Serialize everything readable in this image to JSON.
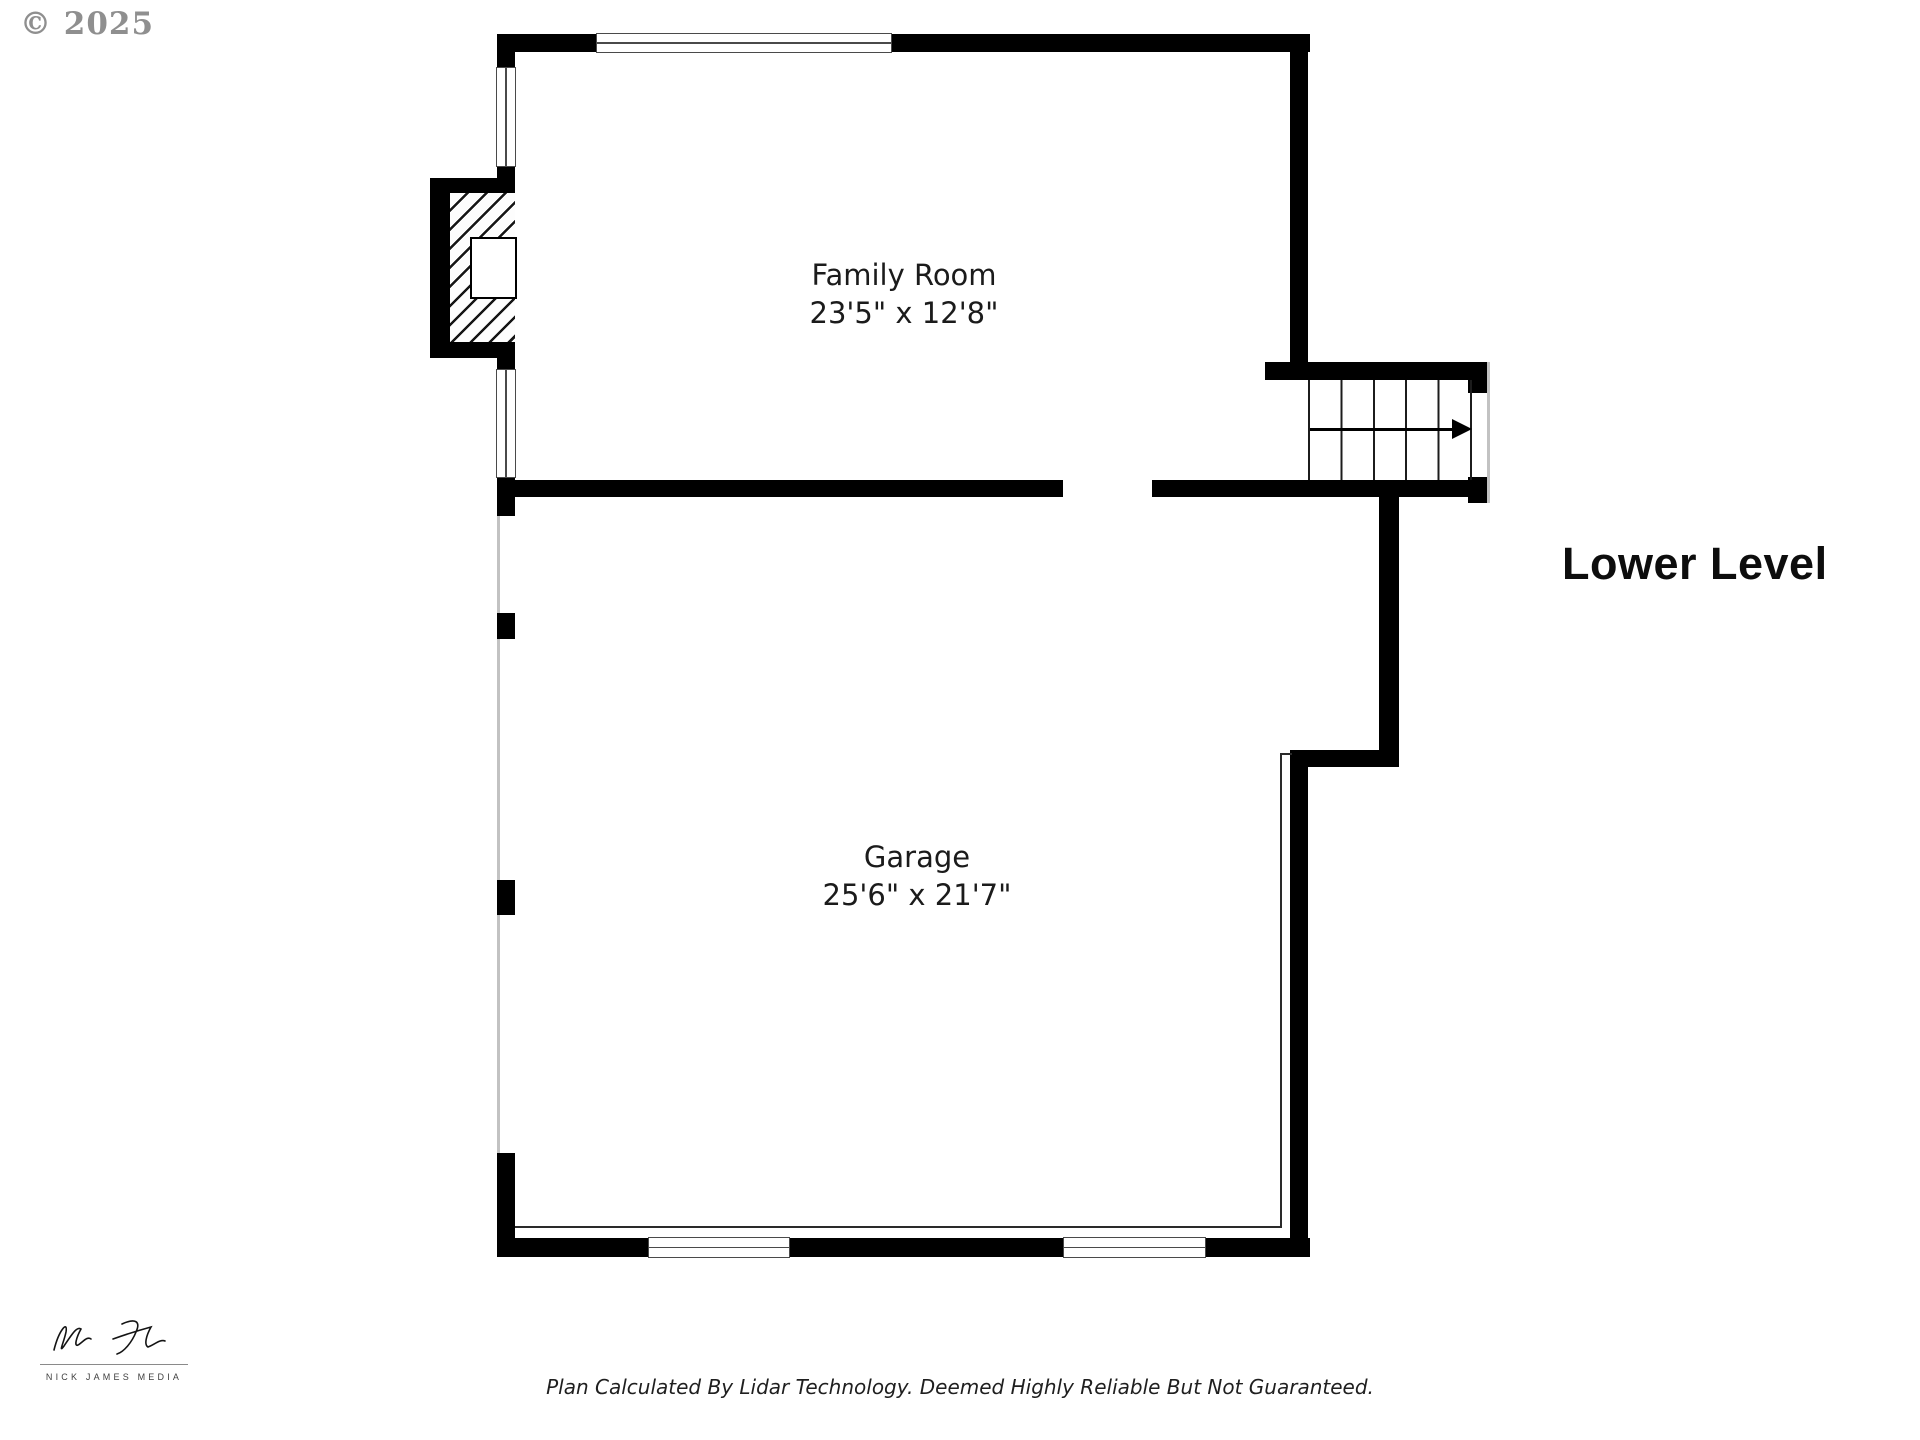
{
  "watermark": {
    "text": "© 2025"
  },
  "plan": {
    "title": "Lower Level",
    "rooms": [
      {
        "name": "Family Room",
        "dimensions": "23'5\" x 12'8\""
      },
      {
        "name": "Garage",
        "dimensions": "25'6\" x 21'7\""
      }
    ],
    "features": {
      "stairs_arrow_direction": "right",
      "fireplace": "hatched masonry fireplace on west wall"
    }
  },
  "footer": {
    "disclaimer": "Plan Calculated By Lidar Technology. Deemed Highly Reliable But Not Guaranteed.",
    "brand": "NICK JAMES MEDIA"
  },
  "colors": {
    "wall": "#000000",
    "background": "#ffffff",
    "watermark_gray": "#8f8f8f",
    "thin_line": "#2a2a2a",
    "open_edge_gray": "#c2c2c2"
  }
}
